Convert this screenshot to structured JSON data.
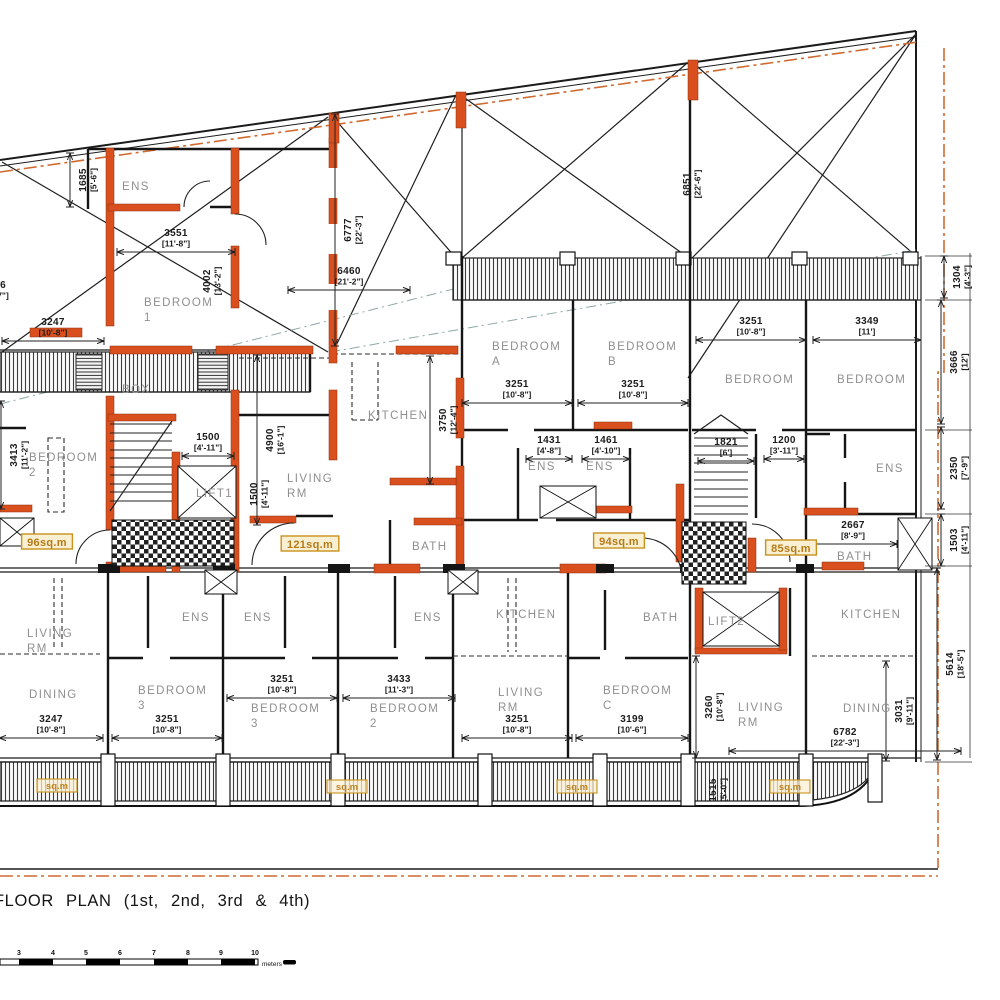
{
  "plan": {
    "title": "FLOOR PLAN (1st, 2nd, 3rd & 4th)",
    "colors": {
      "wall_orange": "#d9501e",
      "boundary_orange": "#cf6a30",
      "area_badge_border": "#c9921c",
      "area_badge_bg": "#f9efd2",
      "room_label_gray": "#8f8f8f"
    },
    "rooms": [
      {
        "label": "ENS",
        "x": 122,
        "y": 190
      },
      {
        "label": "BEDROOM",
        "sub": "1",
        "x": 144,
        "y": 306
      },
      {
        "label": "BOX",
        "x": 122,
        "y": 393
      },
      {
        "label": "BEDROOM",
        "sub": "2",
        "x": 29,
        "y": 461
      },
      {
        "label": "KITCHEN",
        "x": 368,
        "y": 419
      },
      {
        "label": "LIVING",
        "sub": "RM",
        "x": 287,
        "y": 482
      },
      {
        "label": "LIFT1",
        "x": 196,
        "y": 497
      },
      {
        "label": "BATH",
        "x": 412,
        "y": 550
      },
      {
        "label": "BEDROOM",
        "sub": "A",
        "x": 492,
        "y": 350
      },
      {
        "label": "BEDROOM",
        "sub": "B",
        "x": 608,
        "y": 350
      },
      {
        "label": "ENS",
        "x": 528,
        "y": 470
      },
      {
        "label": "ENS",
        "x": 586,
        "y": 470
      },
      {
        "label": "BEDROOM",
        "x": 725,
        "y": 383
      },
      {
        "label": "BEDROOM",
        "x": 837,
        "y": 383
      },
      {
        "label": "ENS",
        "x": 876,
        "y": 472
      },
      {
        "label": "BATH",
        "x": 837,
        "y": 560
      },
      {
        "label": "LIVING",
        "sub": "RM",
        "x": 27,
        "y": 637
      },
      {
        "label": "DINING",
        "x": 29,
        "y": 698
      },
      {
        "label": "ENS",
        "x": 182,
        "y": 621
      },
      {
        "label": "ENS",
        "x": 244,
        "y": 621
      },
      {
        "label": "ENS",
        "x": 414,
        "y": 621
      },
      {
        "label": "KITCHEN",
        "x": 496,
        "y": 618
      },
      {
        "label": "BATH",
        "x": 643,
        "y": 621
      },
      {
        "label": "LIFT2",
        "x": 708,
        "y": 625
      },
      {
        "label": "KITCHEN",
        "x": 841,
        "y": 618
      },
      {
        "label": "BEDROOM",
        "sub": "3",
        "x": 138,
        "y": 694
      },
      {
        "label": "BEDROOM",
        "sub": "3",
        "x": 251,
        "y": 712
      },
      {
        "label": "BEDROOM",
        "sub": "2",
        "x": 370,
        "y": 712
      },
      {
        "label": "LIVING",
        "sub": "RM",
        "x": 498,
        "y": 696
      },
      {
        "label": "BEDROOM",
        "sub": "C",
        "x": 603,
        "y": 694
      },
      {
        "label": "LIVING",
        "sub": "RM",
        "x": 738,
        "y": 711
      },
      {
        "label": "DINING",
        "x": 843,
        "y": 712
      }
    ],
    "dims": [
      {
        "m": "3551",
        "f": "[11'-8\"]",
        "x": 176,
        "y": 236,
        "rot": 0,
        "len": 118
      },
      {
        "m": "1685",
        "f": "[5'-6\"]",
        "x": 86,
        "y": 180,
        "rot": 1,
        "len": 54
      },
      {
        "m": "4002",
        "f": "[13'-2\"]",
        "x": 210,
        "y": 281,
        "rot": 1,
        "len": 0
      },
      {
        "m": "3247",
        "f": "[10'-8\"]",
        "x": 53,
        "y": 325,
        "rot": 0,
        "len": 102
      },
      {
        "m": "6777",
        "f": "[22'-3\"]",
        "x": 351,
        "y": 230,
        "rot": 1,
        "len": 232
      },
      {
        "m": "6460",
        "f": "[21'-2\"]",
        "x": 349,
        "y": 274,
        "rot": 0,
        "len": 122
      },
      {
        "m": "6851",
        "f": "[22'-6\"]",
        "x": 690,
        "y": 184,
        "rot": 1,
        "len": 0
      },
      {
        "m": "3251",
        "f": "[10'-8\"]",
        "x": 517,
        "y": 387,
        "rot": 0,
        "len": 110
      },
      {
        "m": "3251",
        "f": "[10'-8\"]",
        "x": 633,
        "y": 387,
        "rot": 0,
        "len": 110
      },
      {
        "m": "3251",
        "f": "[10'-8\"]",
        "x": 751,
        "y": 324,
        "rot": 0,
        "len": 110
      },
      {
        "m": "3349",
        "f": "[11']",
        "x": 867,
        "y": 324,
        "rot": 0,
        "len": 108
      },
      {
        "m": "1304",
        "f": "[4'-3\"]",
        "x": 960,
        "y": 277,
        "rot": 1,
        "len": 42
      },
      {
        "m": "3666",
        "f": "[12']",
        "x": 957,
        "y": 362,
        "rot": 1,
        "len": 124
      },
      {
        "m": "3750",
        "f": "[12'-4\"]",
        "x": 446,
        "y": 420,
        "rot": 1,
        "len": 128
      },
      {
        "m": "4900",
        "f": "[16'-1\"]",
        "x": 273,
        "y": 440,
        "rot": 1,
        "len": 170
      },
      {
        "m": "1500",
        "f": "[4'-11\"]",
        "x": 208,
        "y": 440,
        "rot": 0,
        "len": 52
      },
      {
        "m": "1500",
        "f": "[4'-11\"]",
        "x": 257,
        "y": 494,
        "rot": 1,
        "len": 0
      },
      {
        "m": "3413",
        "f": "[11'-2\"]",
        "x": 17,
        "y": 455,
        "rot": 1,
        "len": 108
      },
      {
        "m": "1431",
        "f": "[4'-8\"]",
        "x": 549,
        "y": 443,
        "rot": 0,
        "len": 46
      },
      {
        "m": "1461",
        "f": "[4'-10\"]",
        "x": 606,
        "y": 443,
        "rot": 0,
        "len": 48
      },
      {
        "m": "1821",
        "f": "[6']",
        "x": 726,
        "y": 445,
        "rot": 0,
        "len": 56
      },
      {
        "m": "1200",
        "f": "[3'-11\"]",
        "x": 784,
        "y": 443,
        "rot": 0,
        "len": 40
      },
      {
        "m": "2350",
        "f": "[7'-9\"]",
        "x": 957,
        "y": 468,
        "rot": 1,
        "len": 82
      },
      {
        "m": "2667",
        "f": "[8'-9\"]",
        "x": 853,
        "y": 528,
        "rot": 0,
        "len": 88
      },
      {
        "m": "1503",
        "f": "[4'-11\"]",
        "x": 957,
        "y": 540,
        "rot": 1,
        "len": 52
      },
      {
        "m": "3247",
        "f": "[10'-8\"]",
        "x": 51,
        "y": 722,
        "rot": 0,
        "len": 104
      },
      {
        "m": "3251",
        "f": "[10'-8\"]",
        "x": 167,
        "y": 722,
        "rot": 0,
        "len": 110
      },
      {
        "m": "3251",
        "f": "[10'-8\"]",
        "x": 282,
        "y": 682,
        "rot": 0,
        "len": 110
      },
      {
        "m": "3433",
        "f": "[11'-3\"]",
        "x": 399,
        "y": 682,
        "rot": 0,
        "len": 112
      },
      {
        "m": "3251",
        "f": "[10'-8\"]",
        "x": 517,
        "y": 722,
        "rot": 0,
        "len": 110
      },
      {
        "m": "3199",
        "f": "[10'-6\"]",
        "x": 632,
        "y": 722,
        "rot": 0,
        "len": 112
      },
      {
        "m": "3260",
        "f": "[10'-8\"]",
        "x": 712,
        "y": 707,
        "rot": 1,
        "len": 102
      },
      {
        "m": "3031",
        "f": "[9'-11\"]",
        "x": 902,
        "y": 711,
        "rot": 1,
        "len": 100
      },
      {
        "m": "5614",
        "f": "[18'-5\"]",
        "x": 953,
        "y": 664,
        "rot": 1,
        "len": 192
      },
      {
        "m": "6782",
        "f": "[22'-3\"]",
        "x": 845,
        "y": 735,
        "rot": 0,
        "len": 232
      },
      {
        "m": "1515",
        "f": "[5'-0\"]",
        "x": 716,
        "y": 790,
        "rot": 1,
        "len": 0
      },
      {
        "m": "6",
        "f": "7\"]",
        "x": 3,
        "y": 288,
        "rot": 0,
        "len": 0
      }
    ],
    "areas": [
      {
        "label": "96sq.m",
        "x": 47,
        "y": 545
      },
      {
        "label": "121sq.m",
        "x": 310,
        "y": 547
      },
      {
        "label": "94sq.m",
        "x": 619,
        "y": 544
      },
      {
        "label": "85sq.m",
        "x": 791,
        "y": 551
      }
    ],
    "balcony_areas": [
      {
        "label": "sq.m",
        "x": 57,
        "y": 788
      },
      {
        "label": "sq.m",
        "x": 347,
        "y": 789
      },
      {
        "label": "sq.m",
        "x": 577,
        "y": 789
      },
      {
        "label": "sq.m",
        "x": 790,
        "y": 789
      }
    ],
    "scale_bar": {
      "ticks": [
        "3",
        "4",
        "5",
        "6",
        "7",
        "8",
        "9",
        "10"
      ],
      "unit": "meters"
    }
  }
}
